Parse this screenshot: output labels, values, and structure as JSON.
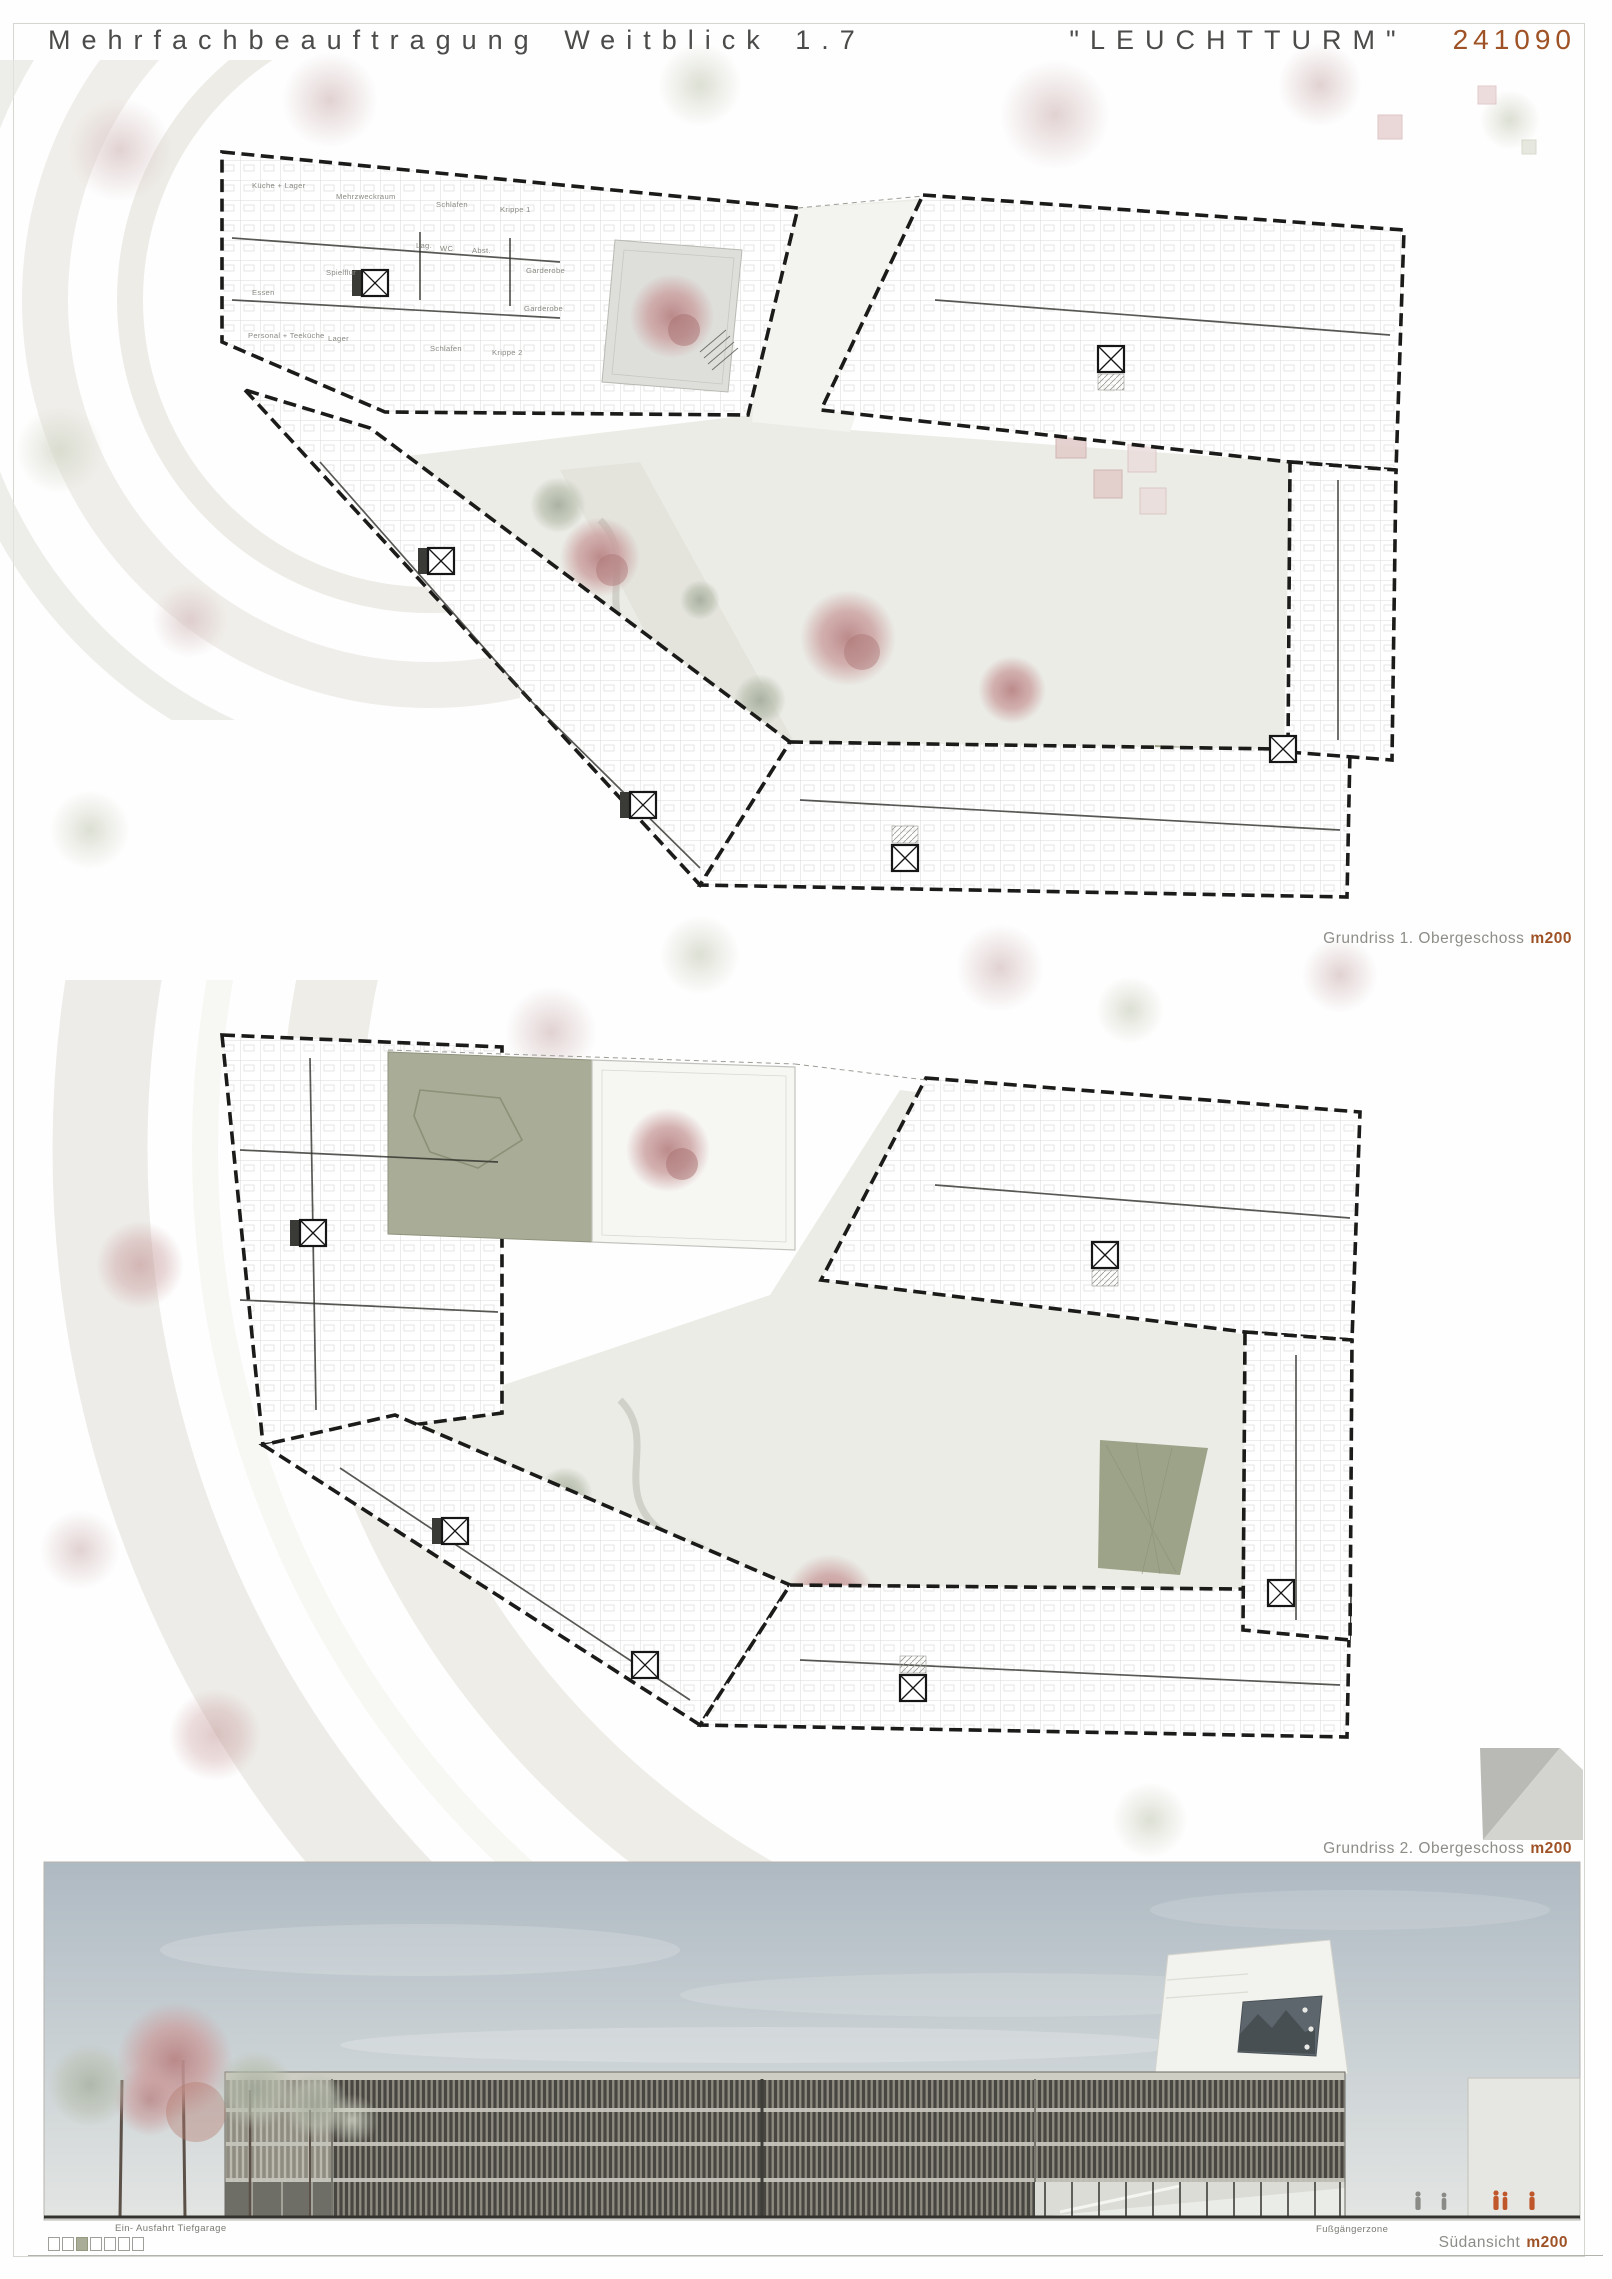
{
  "header": {
    "title": "Mehrfachbeauftragung Weitblick 1.7",
    "project_name": "\"LEUCHTTURM\"",
    "project_number": "241090"
  },
  "plan1": {
    "caption": "Grundriss 1. Obergeschoss",
    "scale_label": "m200",
    "room_labels": [
      "Küche + Lager",
      "Mehrzweckraum",
      "Schlafen",
      "Krippe 1",
      "Lag.",
      "WC",
      "Abst.",
      "Garderobe",
      "Garderobe",
      "Spielflur",
      "Essen",
      "Personal + Teeküche",
      "Lager",
      "Schlafen",
      "Krippe 2"
    ]
  },
  "plan2": {
    "caption": "Grundriss 2. Obergeschoss",
    "scale_label": "m200"
  },
  "elevation": {
    "caption": "Südansicht",
    "scale_label": "m200",
    "label_left": "Ein- Ausfahrt Tiefgarage",
    "label_right": "Fußgängerzone"
  },
  "colors": {
    "accent_orange": "#9e5226",
    "caption_gray": "#8d8d88",
    "courtyard_green": "#a9ac96",
    "plaza_gray": "#ebece6",
    "tree_pink": "#c59494",
    "facade_dark": "#474640",
    "facade_slat": "#8e8b81",
    "sky_top": "#b0bcc4",
    "sky_bottom": "#e0e2e0"
  }
}
